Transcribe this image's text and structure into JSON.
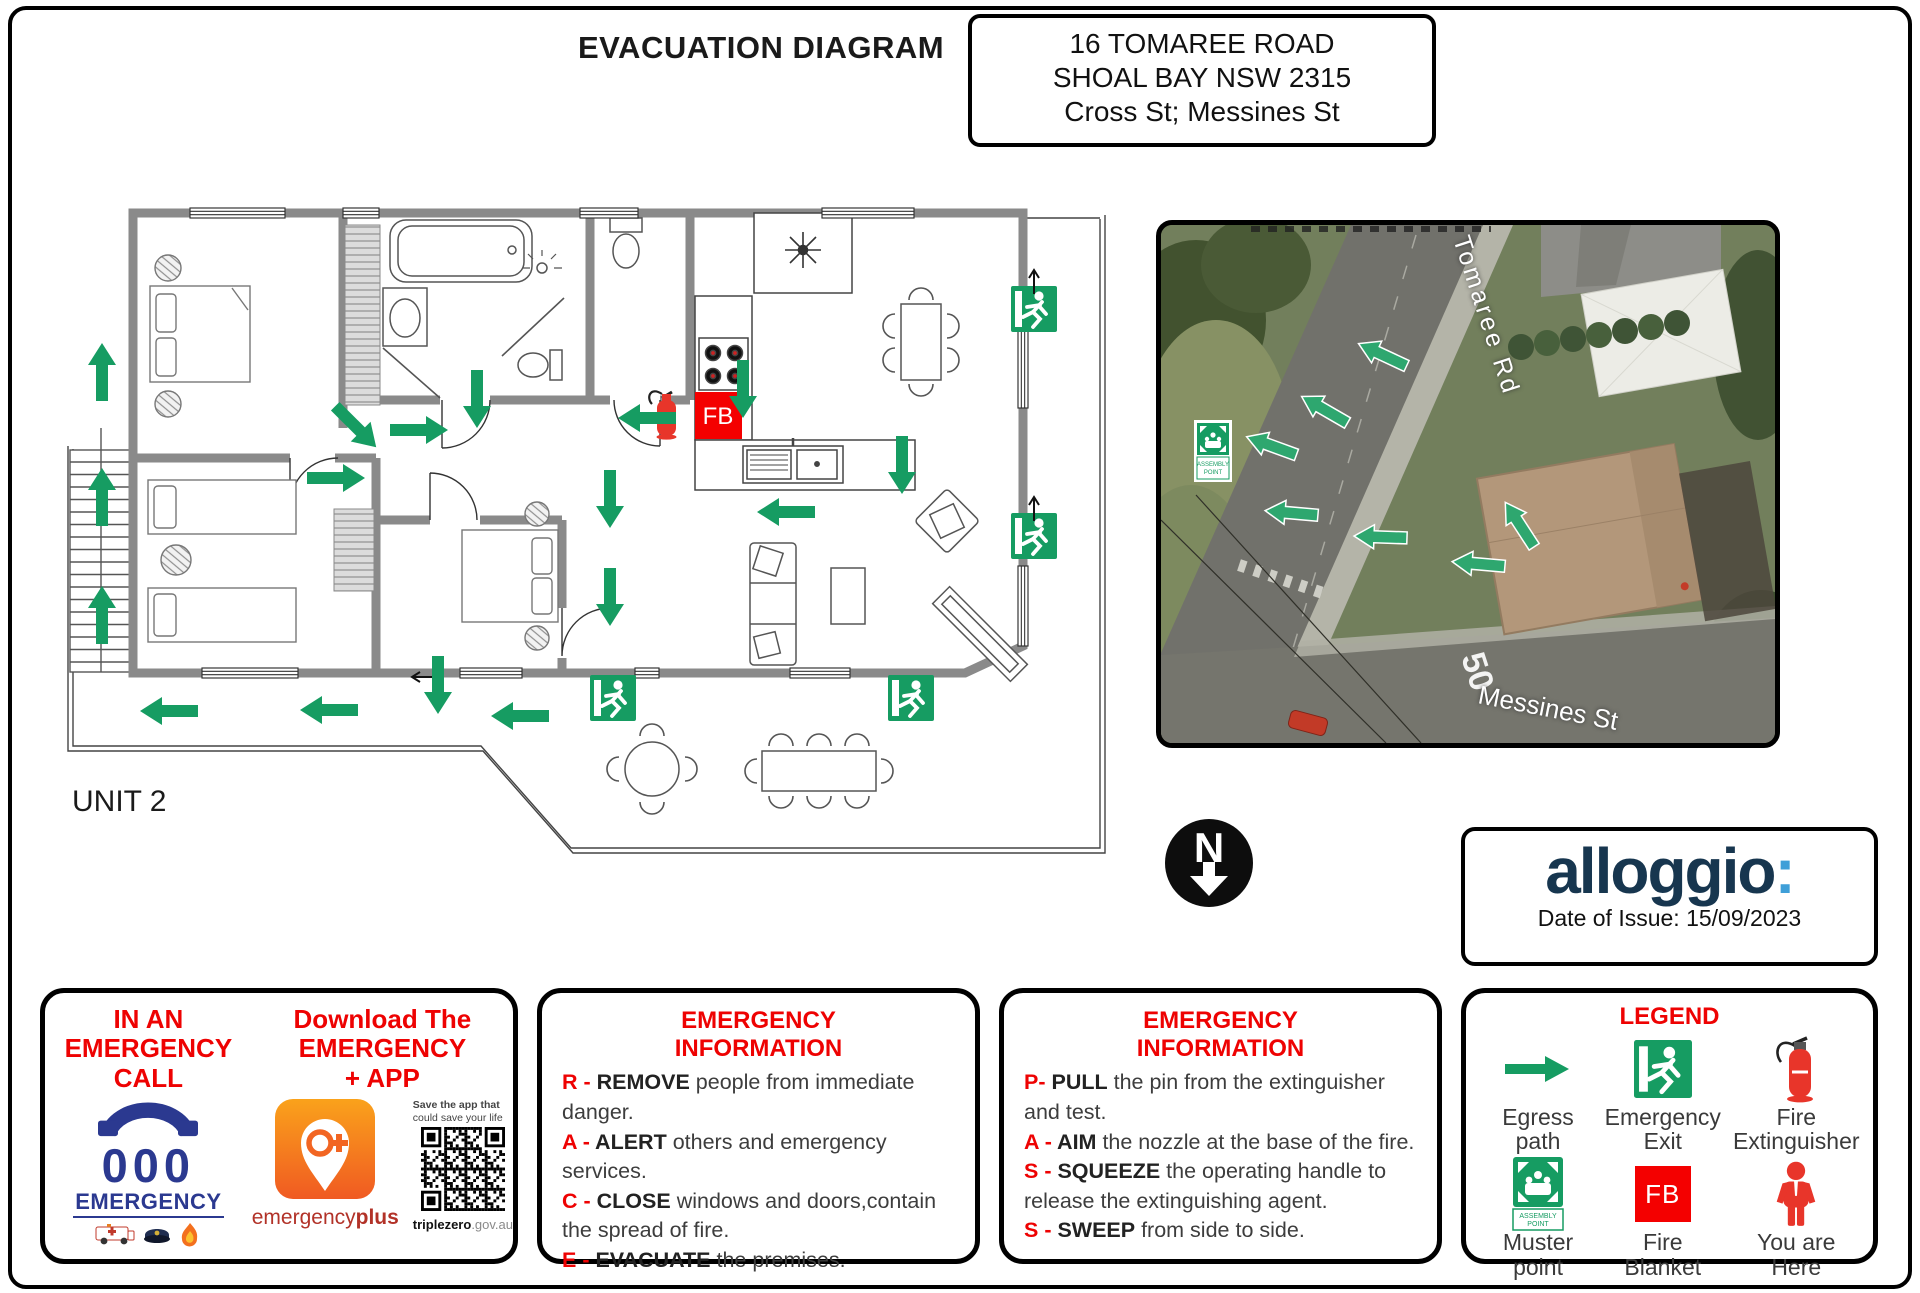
{
  "page": {
    "title": "EVACUATION DIAGRAM"
  },
  "address": {
    "line1": "16 TOMAREE ROAD",
    "line2": "SHOAL BAY NSW 2315",
    "line3": "Cross St; Messines St"
  },
  "floor_plan": {
    "unit_label": "UNIT 2",
    "fire_blanket": "FB"
  },
  "compass": {
    "label": "N"
  },
  "map": {
    "street_vertical": "Tomaree Rd",
    "street_horizontal": "Messines St",
    "speed_marking": "50",
    "assembly_sign_line1": "ASSEMBLY",
    "assembly_sign_line2": "POINT"
  },
  "branding": {
    "name": "alloggio",
    "colon": ":",
    "date_of_issue": "Date of Issue: 15/09/2023"
  },
  "call_panel": {
    "left_title_l1": "IN AN",
    "left_title_l2": "EMERGENCY",
    "left_title_l3": "CALL",
    "right_title_l1": "Download The",
    "right_title_l2": "EMERGENCY",
    "right_title_l3": "+ APP",
    "zero_number": "000",
    "zero_caption": "EMERGENCY",
    "app_caption_regular": "emergency",
    "app_caption_bold": "plus",
    "qr_note_l1": "Save the app that",
    "qr_note_l2": "could save your life",
    "qr_site_bold": "triplezero",
    "qr_site_rest": ".gov.au"
  },
  "race_panel": {
    "title_l1": "EMERGENCY",
    "title_l2": "INFORMATION",
    "items": [
      {
        "prefix": "R - ",
        "keyword": "REMOVE",
        "rest": " people from immediate danger."
      },
      {
        "prefix": "A - ",
        "keyword": "ALERT",
        "rest": " others and emergency services."
      },
      {
        "prefix": "C - ",
        "keyword": "CLOSE",
        "rest": " windows and doors,contain the spread of fire."
      },
      {
        "prefix": "E - ",
        "keyword": "EVACUATE",
        "rest": " the premises."
      }
    ]
  },
  "pass_panel": {
    "title_l1": "EMERGENCY",
    "title_l2": "INFORMATION",
    "items": [
      {
        "prefix": "P- ",
        "keyword": "PULL",
        "rest": " the pin from the extinguisher and test."
      },
      {
        "prefix": "A - ",
        "keyword": "AIM",
        "rest": " the nozzle at the base of the fire."
      },
      {
        "prefix": "S - ",
        "keyword": "SQUEEZE",
        "rest": " the operating handle to release the extinguishing agent."
      },
      {
        "prefix": "S - ",
        "keyword": "SWEEP",
        "rest": " from side to side."
      }
    ]
  },
  "legend": {
    "title": "LEGEND",
    "fire_blanket": "FB",
    "muster_sign_line1": "ASSEMBLY",
    "muster_sign_line2": "POINT",
    "items": [
      {
        "l1": "Egress",
        "l2": "path"
      },
      {
        "l1": "Emergency",
        "l2": "Exit"
      },
      {
        "l1": "Fire",
        "l2": "Extinguisher"
      },
      {
        "l1": "Muster",
        "l2": "point"
      },
      {
        "l1": "Fire",
        "l2": "Blanket"
      },
      {
        "l1": "You are",
        "l2": "Here"
      }
    ]
  },
  "colors": {
    "green": "#169C62",
    "map_green": "#2EA76F",
    "red": "#F40000",
    "navy": "#17364F",
    "logo_blue": "#3F9FD8",
    "wall_gray": "#8A8A8A"
  }
}
